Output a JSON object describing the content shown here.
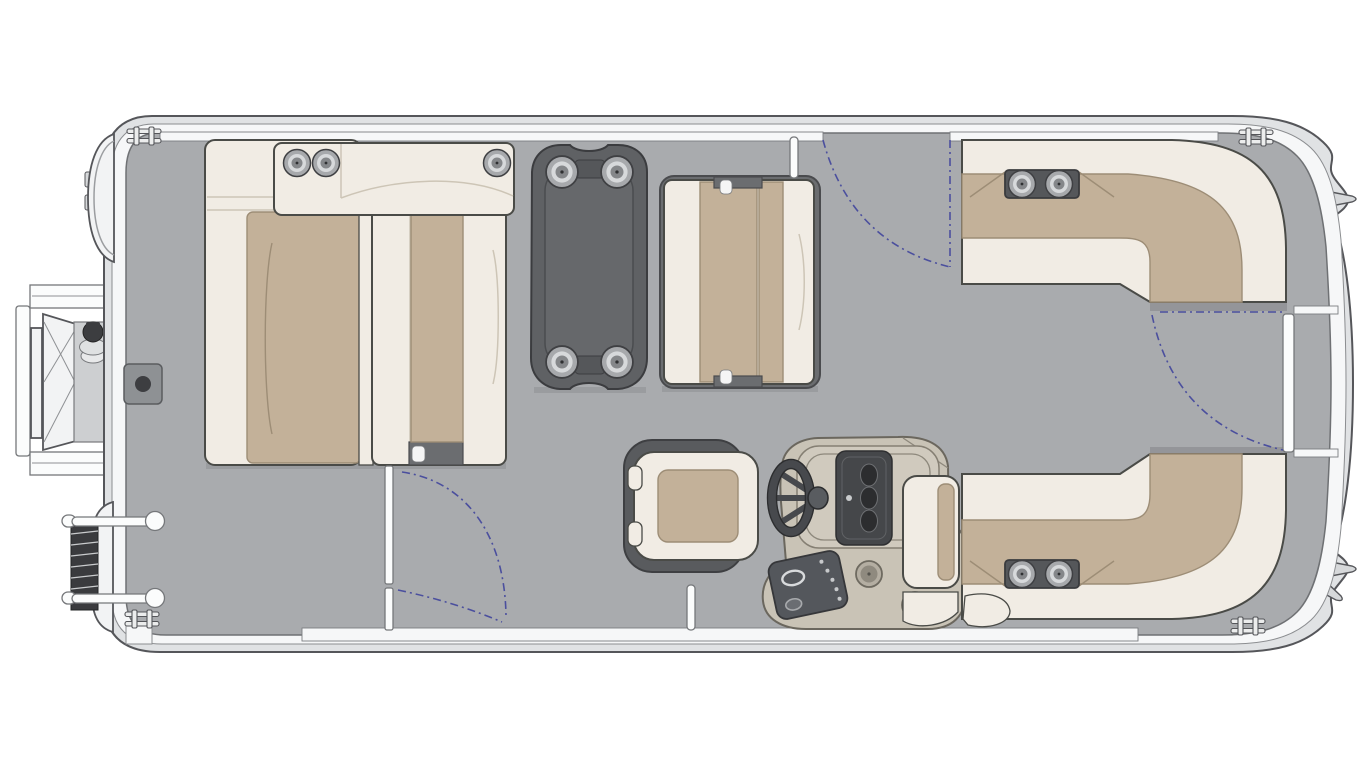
{
  "diagram": {
    "label": "Pontoon boat floor plan, top view",
    "type": "floor-plan",
    "parts": {
      "hull": "Pontoon hull with rub-rail rim and gray vinyl deck",
      "outboard_motor": "Outboard motor cowl at stern (left, top corner)",
      "stern_door": "Open stern boarding door with cross-braced panel and latch knob",
      "boarding_ladder": "Folded telescoping boarding ladder with two grab rails",
      "deck_hatch": "In-floor accessory receptacle (dark square with socket)",
      "bow_armrest_console": "Forward armrest console with three cupholders",
      "port_chaise": "Forward chaise lounge with tan cushion",
      "forward_bench": "Facing bench seat with hinge caps",
      "pedestal_table": "Removable pedestal table with four corner cupholders",
      "mid_bench": "Midship bench seat beside table",
      "captain_chair": "Captain's swivel helm chair",
      "helm_console": "Helm console with instrument cluster, switch panel and two cupholders",
      "steering_wheel": "Three-spoke steering wheel",
      "companion_seat": "Helm companion jump seat",
      "bow_corner_lounge_top": "Wraparound corner lounge with twin-cupholder console (upper)",
      "bow_corner_lounge_bottom": "Wraparound corner lounge with twin-cupholder console (lower)",
      "side_gate_top": "Side entry gate with swing arc",
      "side_gate_bottom": "Side entry gate partition with swing arcs",
      "bow_gate": "Bow walkway gate with swing arc",
      "cleats": "Four mooring cleats",
      "posts": "Bimini / rail support posts"
    },
    "gate_count": 3,
    "cupholder_count": 13
  },
  "colors": {
    "bg": "#ffffff",
    "rimLight": "#e0e2e4",
    "rimWhite": "#f6f7f8",
    "deck": "#a9abae",
    "outline": "#55565a",
    "furnStroke": "#4a4b47",
    "cream": "#f1ece4",
    "tan": "#c3b199",
    "tanDark": "#9d8d76",
    "seam": "#cdc5b6",
    "darkGray": "#5f6164",
    "darker": "#3b3c3f",
    "metal": "#a7a9ac",
    "consoleTan": "#c9c3b6",
    "consoleStroke": "#6b675e",
    "panelDark": "#54575c",
    "wheel": "#47494d",
    "arcBlue": "#4b4f9e",
    "shadow": "#8e9094"
  }
}
